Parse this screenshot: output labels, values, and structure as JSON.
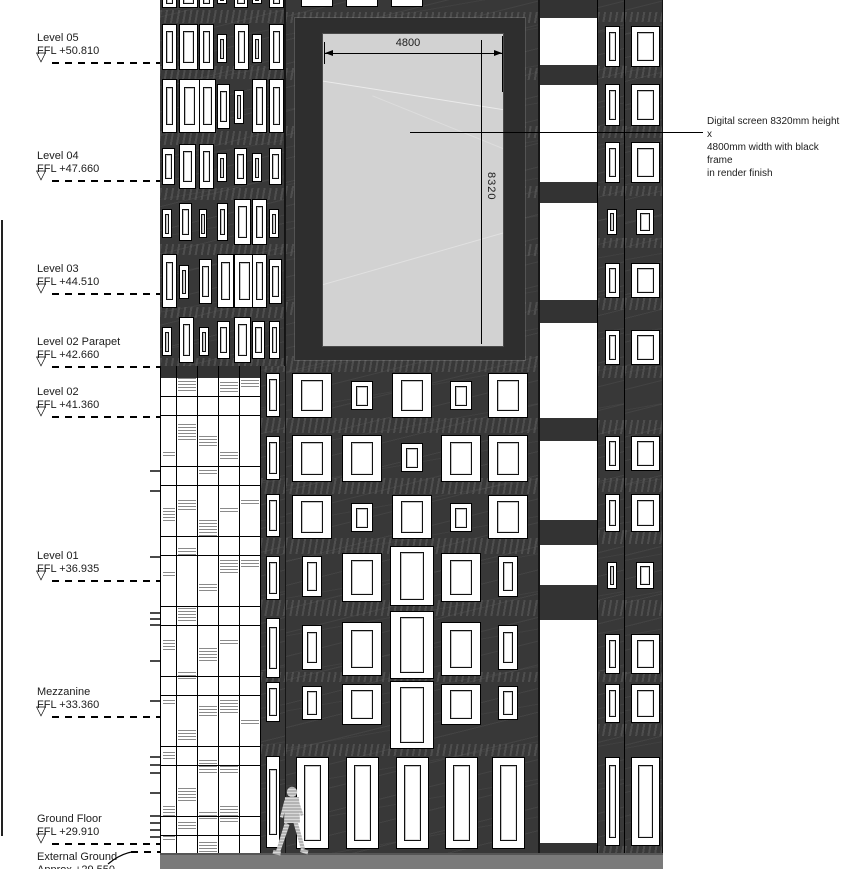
{
  "levels": [
    {
      "name": "Level 05",
      "ffl": "FFL +50.810"
    },
    {
      "name": "Level 04",
      "ffl": "FFL +47.660"
    },
    {
      "name": "Level 03",
      "ffl": "FFL +44.510"
    },
    {
      "name": "Level 02 Parapet",
      "ffl": "FFL +42.660"
    },
    {
      "name": "Level 02",
      "ffl": "FFL +41.360"
    },
    {
      "name": "Level 01",
      "ffl": "FFL +36.935"
    },
    {
      "name": "Mezzanine",
      "ffl": "FFL +33.360"
    },
    {
      "name": "Ground Floor",
      "ffl": "FFL +29.910"
    }
  ],
  "external_ground": {
    "name": "External Ground",
    "value": "Approx +29.550"
  },
  "dimensions": {
    "width_mm": "4800",
    "height_mm": "8320"
  },
  "screen_annotation": {
    "text": "Digital screen 8320mm height x 4800mm width with black frame in render finish",
    "lines": [
      "Digital screen 8320mm height x",
      "4800mm width with black frame",
      "in render finish"
    ]
  },
  "colors": {
    "facade": "#383838",
    "screen": "#d2d2d2",
    "ground": "#7a7a7a",
    "hatch": "#5d5d5d",
    "person": "#b4b4b4"
  }
}
